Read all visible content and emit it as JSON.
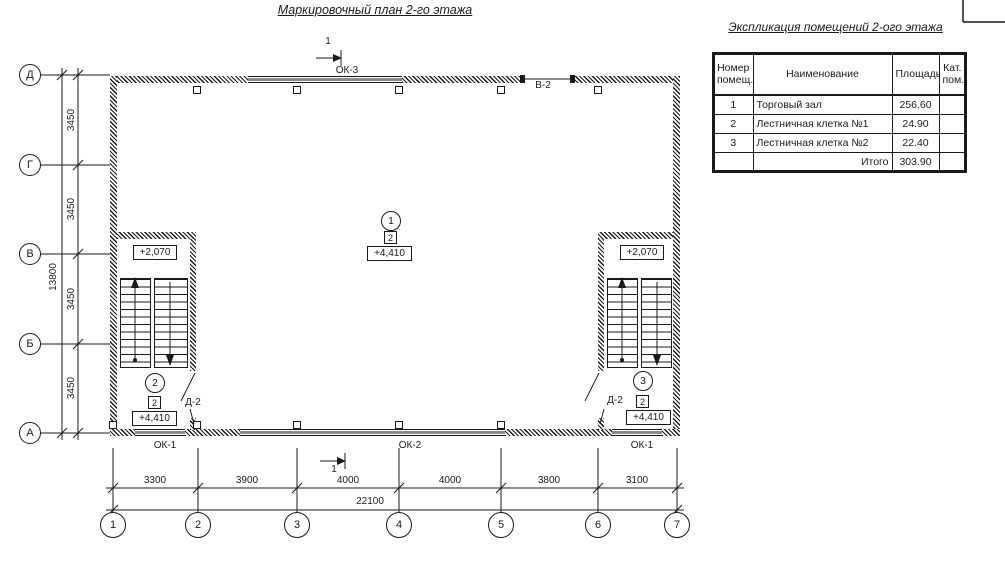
{
  "colors": {
    "line": "#1a1a1a",
    "window_gray": "#8a8a8a",
    "background": "#ffffff"
  },
  "plan": {
    "title": "Маркировочный план 2-го этажа",
    "axes_left": [
      "Д",
      "Г",
      "В",
      "Б",
      "А"
    ],
    "axes_bottom": [
      "1",
      "2",
      "3",
      "4",
      "5",
      "6",
      "7"
    ],
    "dims_left": [
      "3450",
      "3450",
      "3450",
      "3450"
    ],
    "dims_left_total": "13800",
    "dims_bottom": [
      "3300",
      "3900",
      "4000",
      "4000",
      "3800",
      "3100"
    ],
    "dims_bottom_total": "22100",
    "section_mark": "1",
    "openings": {
      "ok3": "ОК-3",
      "v2": "В-2",
      "ok1_left": "ОК-1",
      "ok2": "ОК-2",
      "ok1_right": "ОК-1",
      "d2_left": "Д-2",
      "d2_right": "Д-2"
    },
    "markers": {
      "hall": {
        "room": "1",
        "cat": "2",
        "elev": "+4,410"
      },
      "stair_left": {
        "room": "2",
        "cat": "2",
        "elev": "+4,410",
        "landing_elev": "+2,070"
      },
      "stair_right": {
        "room": "3",
        "cat": "2",
        "elev": "+4,410",
        "landing_elev": "+2,070"
      }
    }
  },
  "table": {
    "title": "Экспликация помещений 2-ого этажа",
    "headers": [
      "Номер помещ.",
      "Наименование",
      "Площадь",
      "Кат. пом."
    ],
    "rows": [
      {
        "num": "1",
        "name": "Торговый зал",
        "area": "256.60",
        "cat": ""
      },
      {
        "num": "2",
        "name": "Лестничная клетка №1",
        "area": "24.90",
        "cat": ""
      },
      {
        "num": "3",
        "name": "Лестничная клетка №2",
        "area": "22.40",
        "cat": ""
      }
    ],
    "total_label": "Итого",
    "total_value": "303.90"
  }
}
